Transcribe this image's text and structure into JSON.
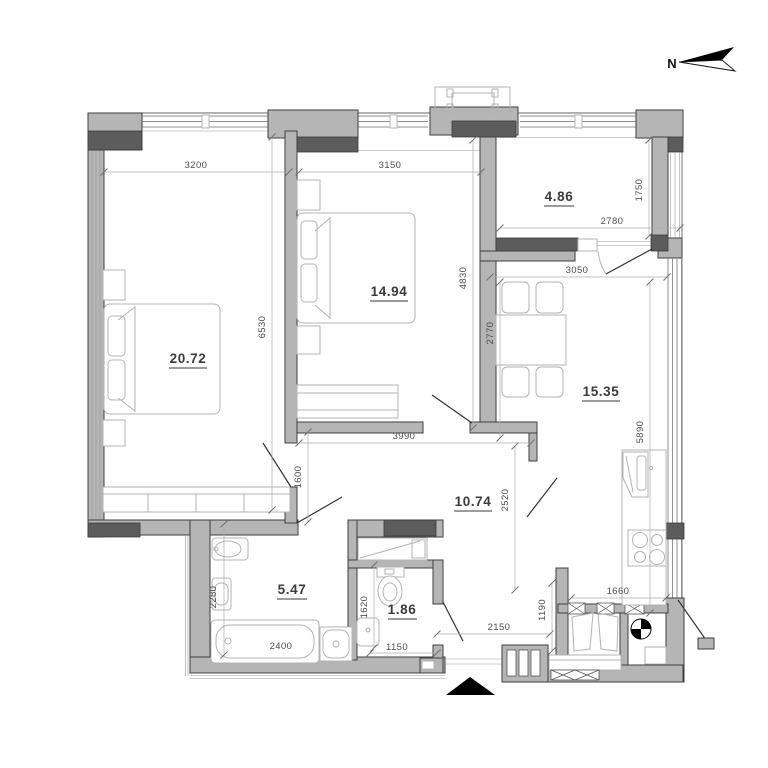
{
  "north": {
    "label": "N"
  },
  "rooms": {
    "bedroom_large": {
      "area": "20.72"
    },
    "bedroom_small": {
      "area": "14.94"
    },
    "storage": {
      "area": "4.86"
    },
    "kitchen_living": {
      "area": "15.35"
    },
    "hallway": {
      "area": "10.74"
    },
    "bathroom": {
      "area": "5.47"
    },
    "wc": {
      "area": "1.86"
    }
  },
  "dimensions": {
    "bedroom_large_width": "3200",
    "bedroom_small_width": "3150",
    "bedroom_large_height": "6530",
    "bedroom_small_height": "4830",
    "storage_height": "1750",
    "storage_width": "2780",
    "kitchen_width": "3050",
    "dining_depth": "2770",
    "kitchen_height": "5890",
    "hall_width": "3990",
    "hall_left_height": "1600",
    "hall_right_height": "2520",
    "bathroom_depth": "2280",
    "bathtub_length": "2400",
    "wc_depth": "1620",
    "wc_width": "1150",
    "entry_width": "2150",
    "vestibule_depth": "1190",
    "counter_width": "1660"
  },
  "colors": {
    "wall_fill": "#b5b5b5",
    "pier_fill": "#5c5c5c",
    "marker_black": "#000000"
  }
}
